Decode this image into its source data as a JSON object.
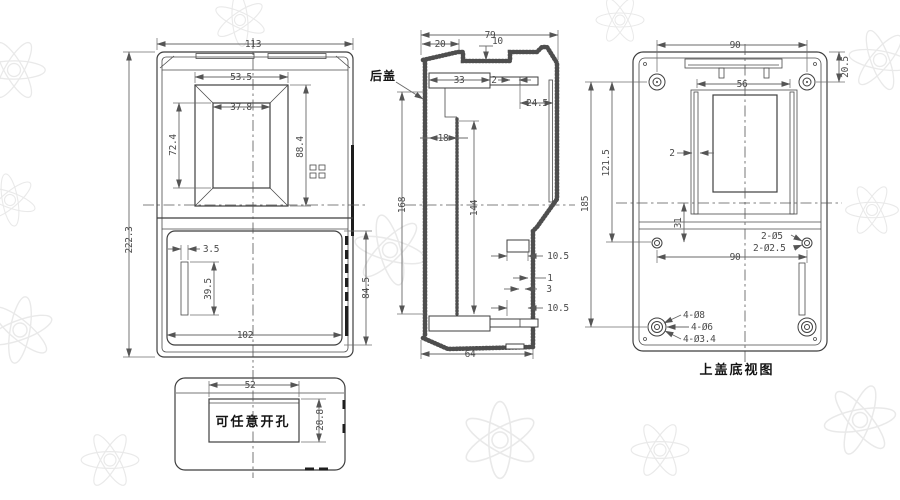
{
  "drawing": {
    "front_view": {
      "dim_width": "113",
      "dim_height": "222.3",
      "dim_window_outer_w": "53.5",
      "dim_window_inner_w": "37.8",
      "dim_window_inner_h": "72.4",
      "dim_window_outer_h": "88.4",
      "dim_slot_w": "3.5",
      "dim_slot_h": "39.5",
      "dim_lower_w": "102",
      "dim_lower_h": "84.5"
    },
    "knockout_view": {
      "dim_opening_w": "52",
      "dim_opening_h": "28.8",
      "note": "可任意开孔"
    },
    "section_view": {
      "label_rear_cover": "后盖",
      "dim_total_w": "79",
      "dim_top_left": "20",
      "dim_notch_depth": "10",
      "dim_tongue_w": "33",
      "dim_gap": "2",
      "dim_right_inset": "24.5",
      "dim_wall_offset": "18",
      "dim_cavity_h": "168",
      "dim_inner_h": "144",
      "dim_step_top": "10.5",
      "dim_lip_a": "1",
      "dim_lip_b": "3",
      "dim_step_bottom": "10.5",
      "dim_bottom_w": "64"
    },
    "cover_view": {
      "caption": "上盖底视图",
      "dim_boss_span_top": "90",
      "dim_top_offset": "20.5",
      "dim_window_w": "56",
      "dim_rib_t": "2",
      "dim_boss_v_mid": "121.5",
      "dim_boss_v_full": "185",
      "dim_center_offset": "31",
      "dim_hole_span": "90",
      "label_holes_a": "2-Ø5",
      "label_holes_b": "2-Ø2.5",
      "label_boss_a": "4-Ø8",
      "label_boss_b": "4-Ø6",
      "label_boss_c": "4-Ø3.4"
    }
  }
}
